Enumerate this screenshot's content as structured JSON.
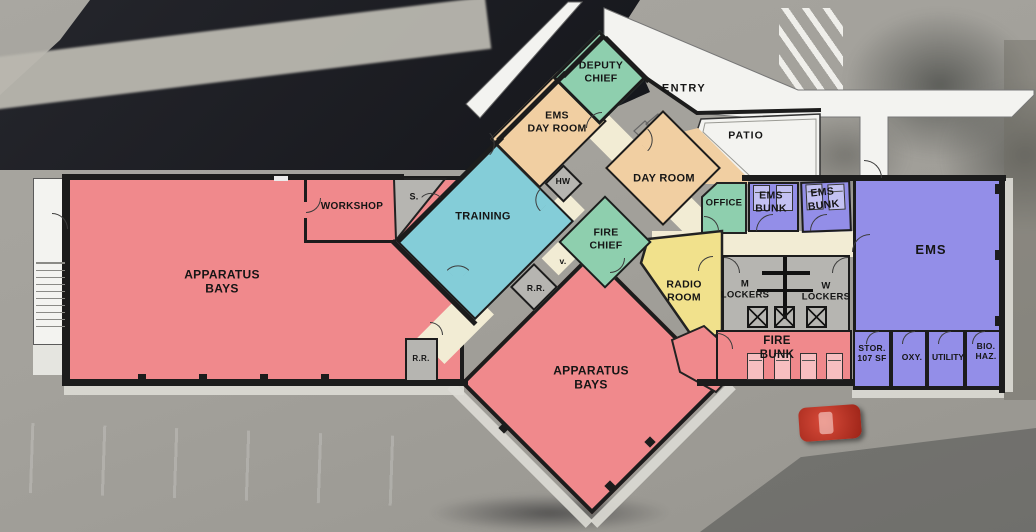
{
  "plan_title": "Fire Station Floor Plan",
  "colors": {
    "apparatus_pink": "#F0898C",
    "training_teal": "#84CDD8",
    "office_green": "#8ECFAE",
    "dayroom_tan": "#F1CFA2",
    "ems_purple": "#938EE8",
    "radio_yellow": "#F1E18C",
    "service_gray": "#B6B5B1",
    "corridor_cream": "#F2ECD4",
    "wall_black": "#1C1C1C",
    "plan_white": "#F3F3F0"
  },
  "rooms": {
    "apparatus_bays_west": "APPARATUS\nBAYS",
    "apparatus_bays_south": "APPARATUS\nBAYS",
    "workshop": "WORKSHOP",
    "storage_s": "S.",
    "training": "TRAINING",
    "ems_day_room": "EMS\nDAY ROOM",
    "deputy_chief": "DEPUTY\nCHIEF",
    "entry": "ENTRY",
    "day_room": "DAY ROOM",
    "patio": "PATIO",
    "hot_water": "HW",
    "fire_chief": "FIRE\nCHIEF",
    "vestibule": "v.",
    "restroom_center": "R.R.",
    "restroom_west": "R.R.",
    "radio_room": "RADIO\nROOM",
    "office": "OFFICE",
    "ems_bunk_1": "EMS\nBUNK",
    "ems_bunk_2": "EMS\nBUNK",
    "ems": "EMS",
    "m_lockers": "M\nLOCKERS",
    "w_lockers": "W\nLOCKERS",
    "fire_bunk": "FIRE\nBUNK",
    "storage_107": "STOR.\n107 SF",
    "oxygen": "OXY.",
    "utility": "UTILITY",
    "bio_hazard": "BIO.\nHAZ."
  }
}
